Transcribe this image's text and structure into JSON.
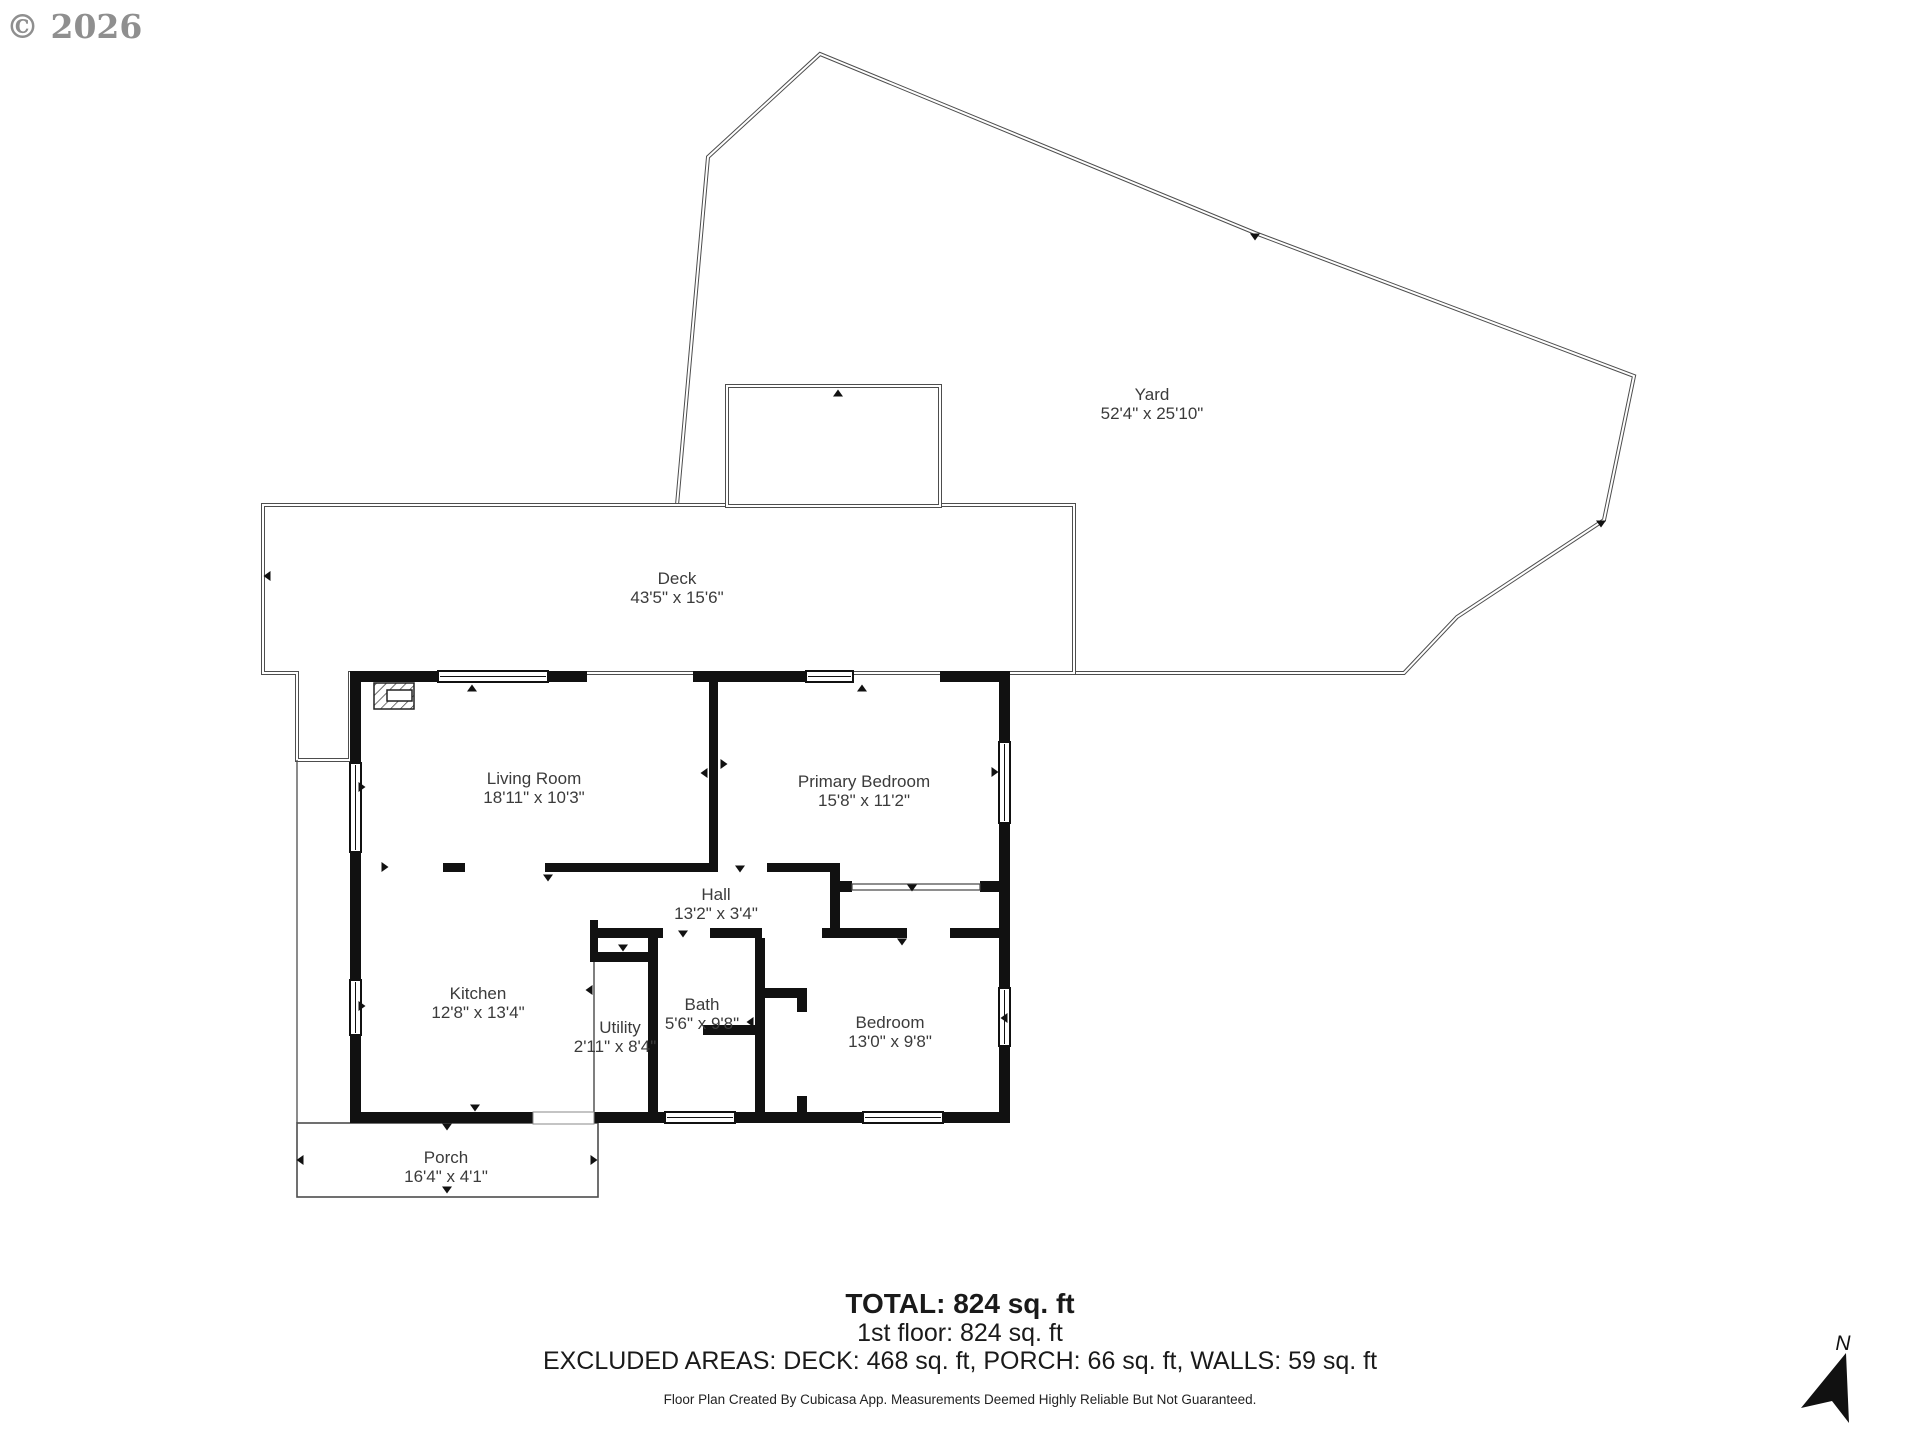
{
  "watermark": "© 2026",
  "rooms": {
    "yard": {
      "name": "Yard",
      "dims": "52'4\" x 25'10\""
    },
    "deck": {
      "name": "Deck",
      "dims": "43'5\" x 15'6\""
    },
    "living": {
      "name": "Living Room",
      "dims": "18'11\" x 10'3\""
    },
    "primary": {
      "name": "Primary Bedroom",
      "dims": "15'8\" x 11'2\""
    },
    "hall": {
      "name": "Hall",
      "dims": "13'2\" x 3'4\""
    },
    "kitchen": {
      "name": "Kitchen",
      "dims": "12'8\" x 13'4\""
    },
    "utility": {
      "name": "Utility",
      "dims": "2'11\" x 8'4\""
    },
    "bath": {
      "name": "Bath",
      "dims": "5'6\" x 9'8\""
    },
    "bedroom": {
      "name": "Bedroom",
      "dims": "13'0\" x 9'8\""
    },
    "porch": {
      "name": "Porch",
      "dims": "16'4\" x 4'1\""
    }
  },
  "footer": {
    "total": "TOTAL: 824 sq. ft",
    "floor": "1st floor: 824 sq. ft",
    "excluded": "EXCLUDED AREAS: DECK: 468 sq. ft, PORCH: 66 sq. ft, WALLS: 59 sq. ft",
    "disclaimer": "Floor Plan Created By Cubicasa App. Measurements Deemed Highly Reliable But Not Guaranteed."
  },
  "north": {
    "label": "N"
  },
  "colors": {
    "wall": "#111111",
    "outline": "#4d4d4d",
    "label": "#3b3b3b",
    "watermark": "#8f8f8f"
  }
}
